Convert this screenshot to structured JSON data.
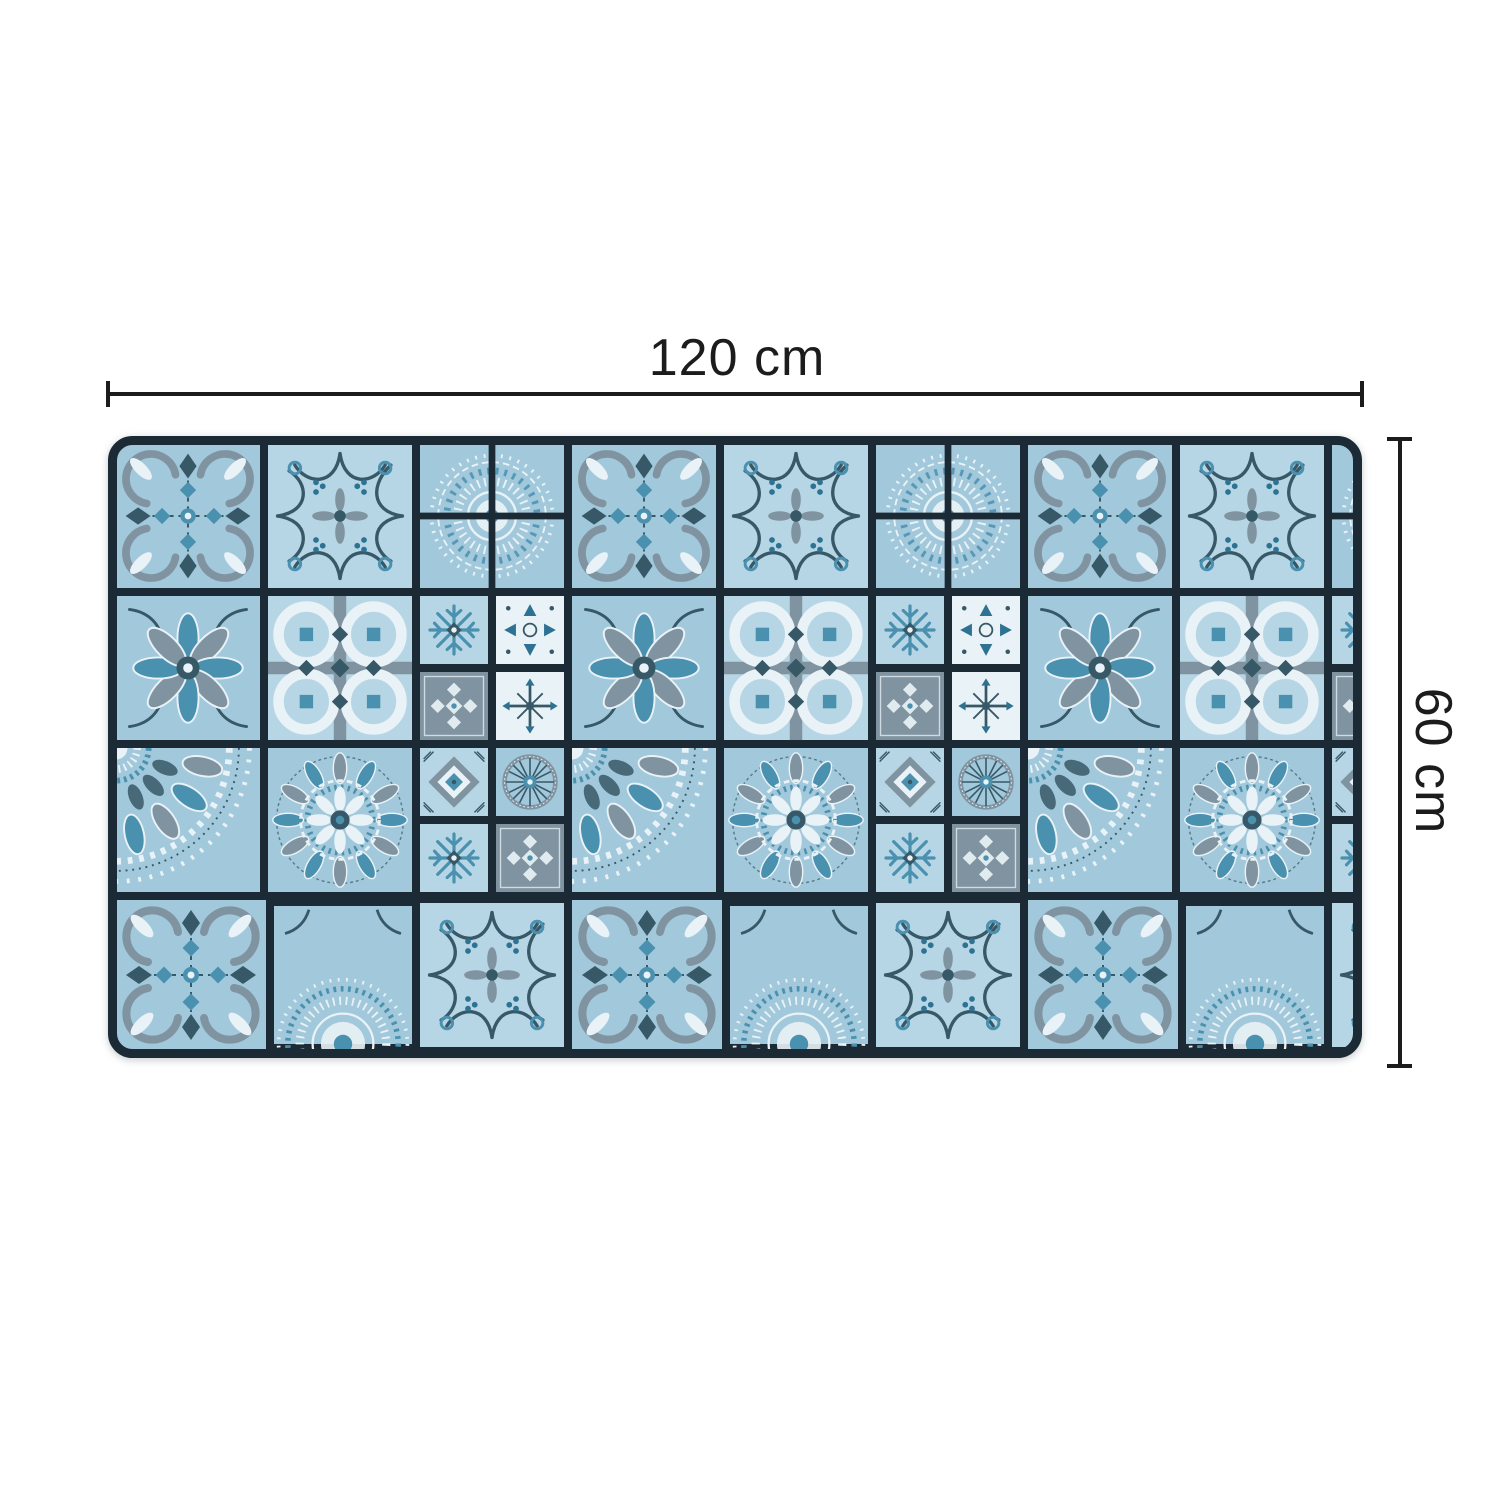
{
  "product_diagram": {
    "width_label": "120 cm",
    "height_label": "60 cm",
    "image_name": "azulejo-patchwork-mat"
  },
  "palette": {
    "background": "#ffffff",
    "dimension": "#1c1c1c",
    "grout": "#1b2a34",
    "tile": "#a2c8db",
    "tile2": "#b7d6e5",
    "white": "#e9f2f6",
    "gray": "#8093a0",
    "dark": "#375866",
    "teal": "#4a90af",
    "teal_dark": "#2e7293"
  }
}
